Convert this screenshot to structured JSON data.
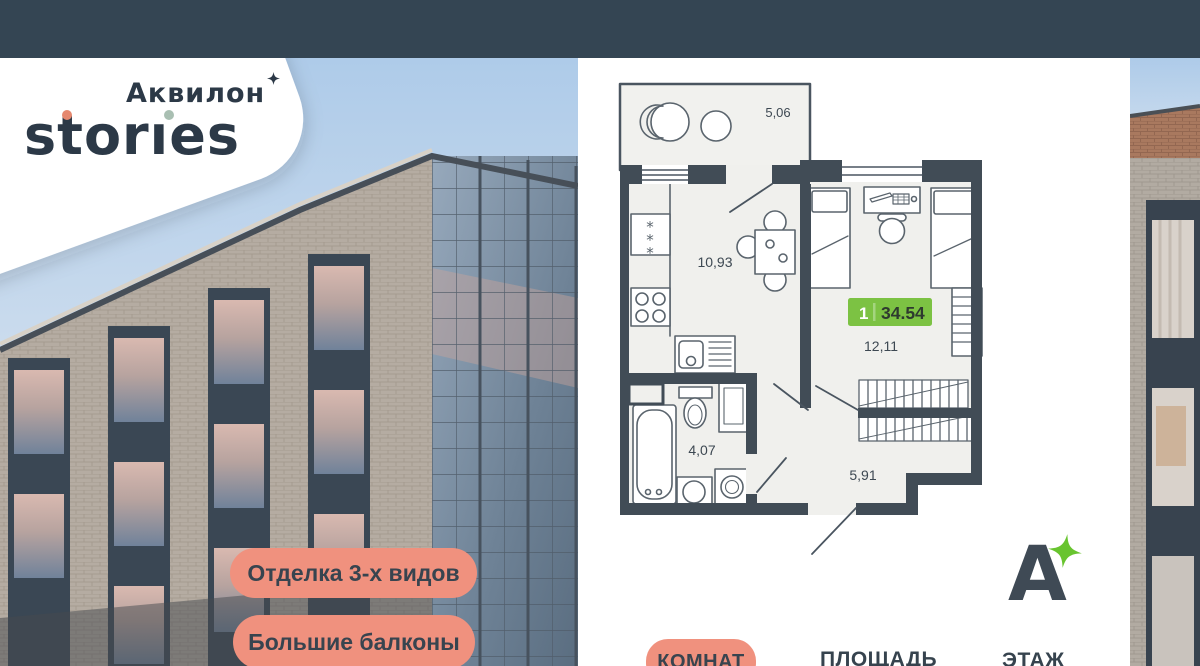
{
  "brand": {
    "name_line1": "Аквилон",
    "name_line2": "storıes"
  },
  "badges": [
    {
      "label": "Отделка 3-х видов"
    },
    {
      "label": "Большие балконы"
    }
  ],
  "plan": {
    "total_badge": {
      "rooms": "1",
      "area": "34.54"
    },
    "rooms": [
      {
        "name": "balcony",
        "area": "5,06"
      },
      {
        "name": "kitchen-living",
        "area": "10,93"
      },
      {
        "name": "bedroom",
        "area": "12,11"
      },
      {
        "name": "bathroom",
        "area": "4,07"
      },
      {
        "name": "hallway",
        "area": "5,91"
      }
    ]
  },
  "footer": {
    "rooms_label": "КОМНАТ",
    "area_label": "ПЛОЩАДЬ",
    "floor_label": "ЭТАЖ"
  },
  "brand_mark": {
    "letter": "А"
  },
  "colors": {
    "topbar": "#344553",
    "salmon": "#f0917e",
    "green_badge": "#7cc243",
    "star_green": "#68c42f",
    "navy_text": "#2c3947",
    "wall": "#414c56"
  }
}
